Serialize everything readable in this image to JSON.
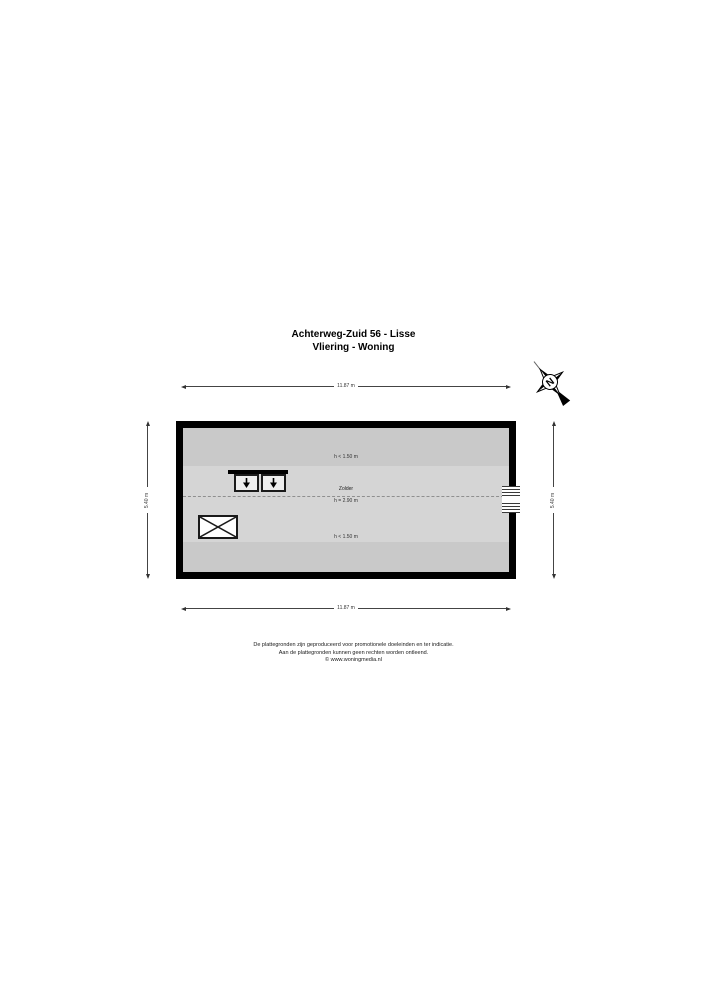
{
  "title": {
    "line1": "Achterweg-Zuid 56 - Lisse",
    "line2": "Vliering - Woning"
  },
  "compass": {
    "label": "N"
  },
  "dimensions": {
    "top": "11.87 m",
    "bottom": "11.87 m",
    "left": "5.40 m",
    "right": "5.40 m"
  },
  "plan": {
    "zones": [
      {
        "id": "top-low-headroom",
        "label": "h < 1.50 m",
        "color": "#c9c9c9"
      },
      {
        "id": "zolder",
        "label": "Zolder",
        "height_label": "h = 2.90 m",
        "color": "#d5d5d5"
      },
      {
        "id": "bottom-low-headroom",
        "label": "h < 1.50 m",
        "color": "#c9c9c9"
      }
    ],
    "wall_color": "#000000"
  },
  "icons": {
    "compass": "north-arrow",
    "roof_window": "down-arrow-in-square",
    "floor_opening": "crossed-rectangle",
    "wall_window": "horizontal-glazing-lines"
  },
  "footer": {
    "line1": "De plattegronden zijn geproduceerd voor promotionele doeleinden en ter indicatie.",
    "line2": "Aan de plattegronden kunnen geen rechten worden ontleend.",
    "line3": "© www.woningmedia.nl"
  }
}
